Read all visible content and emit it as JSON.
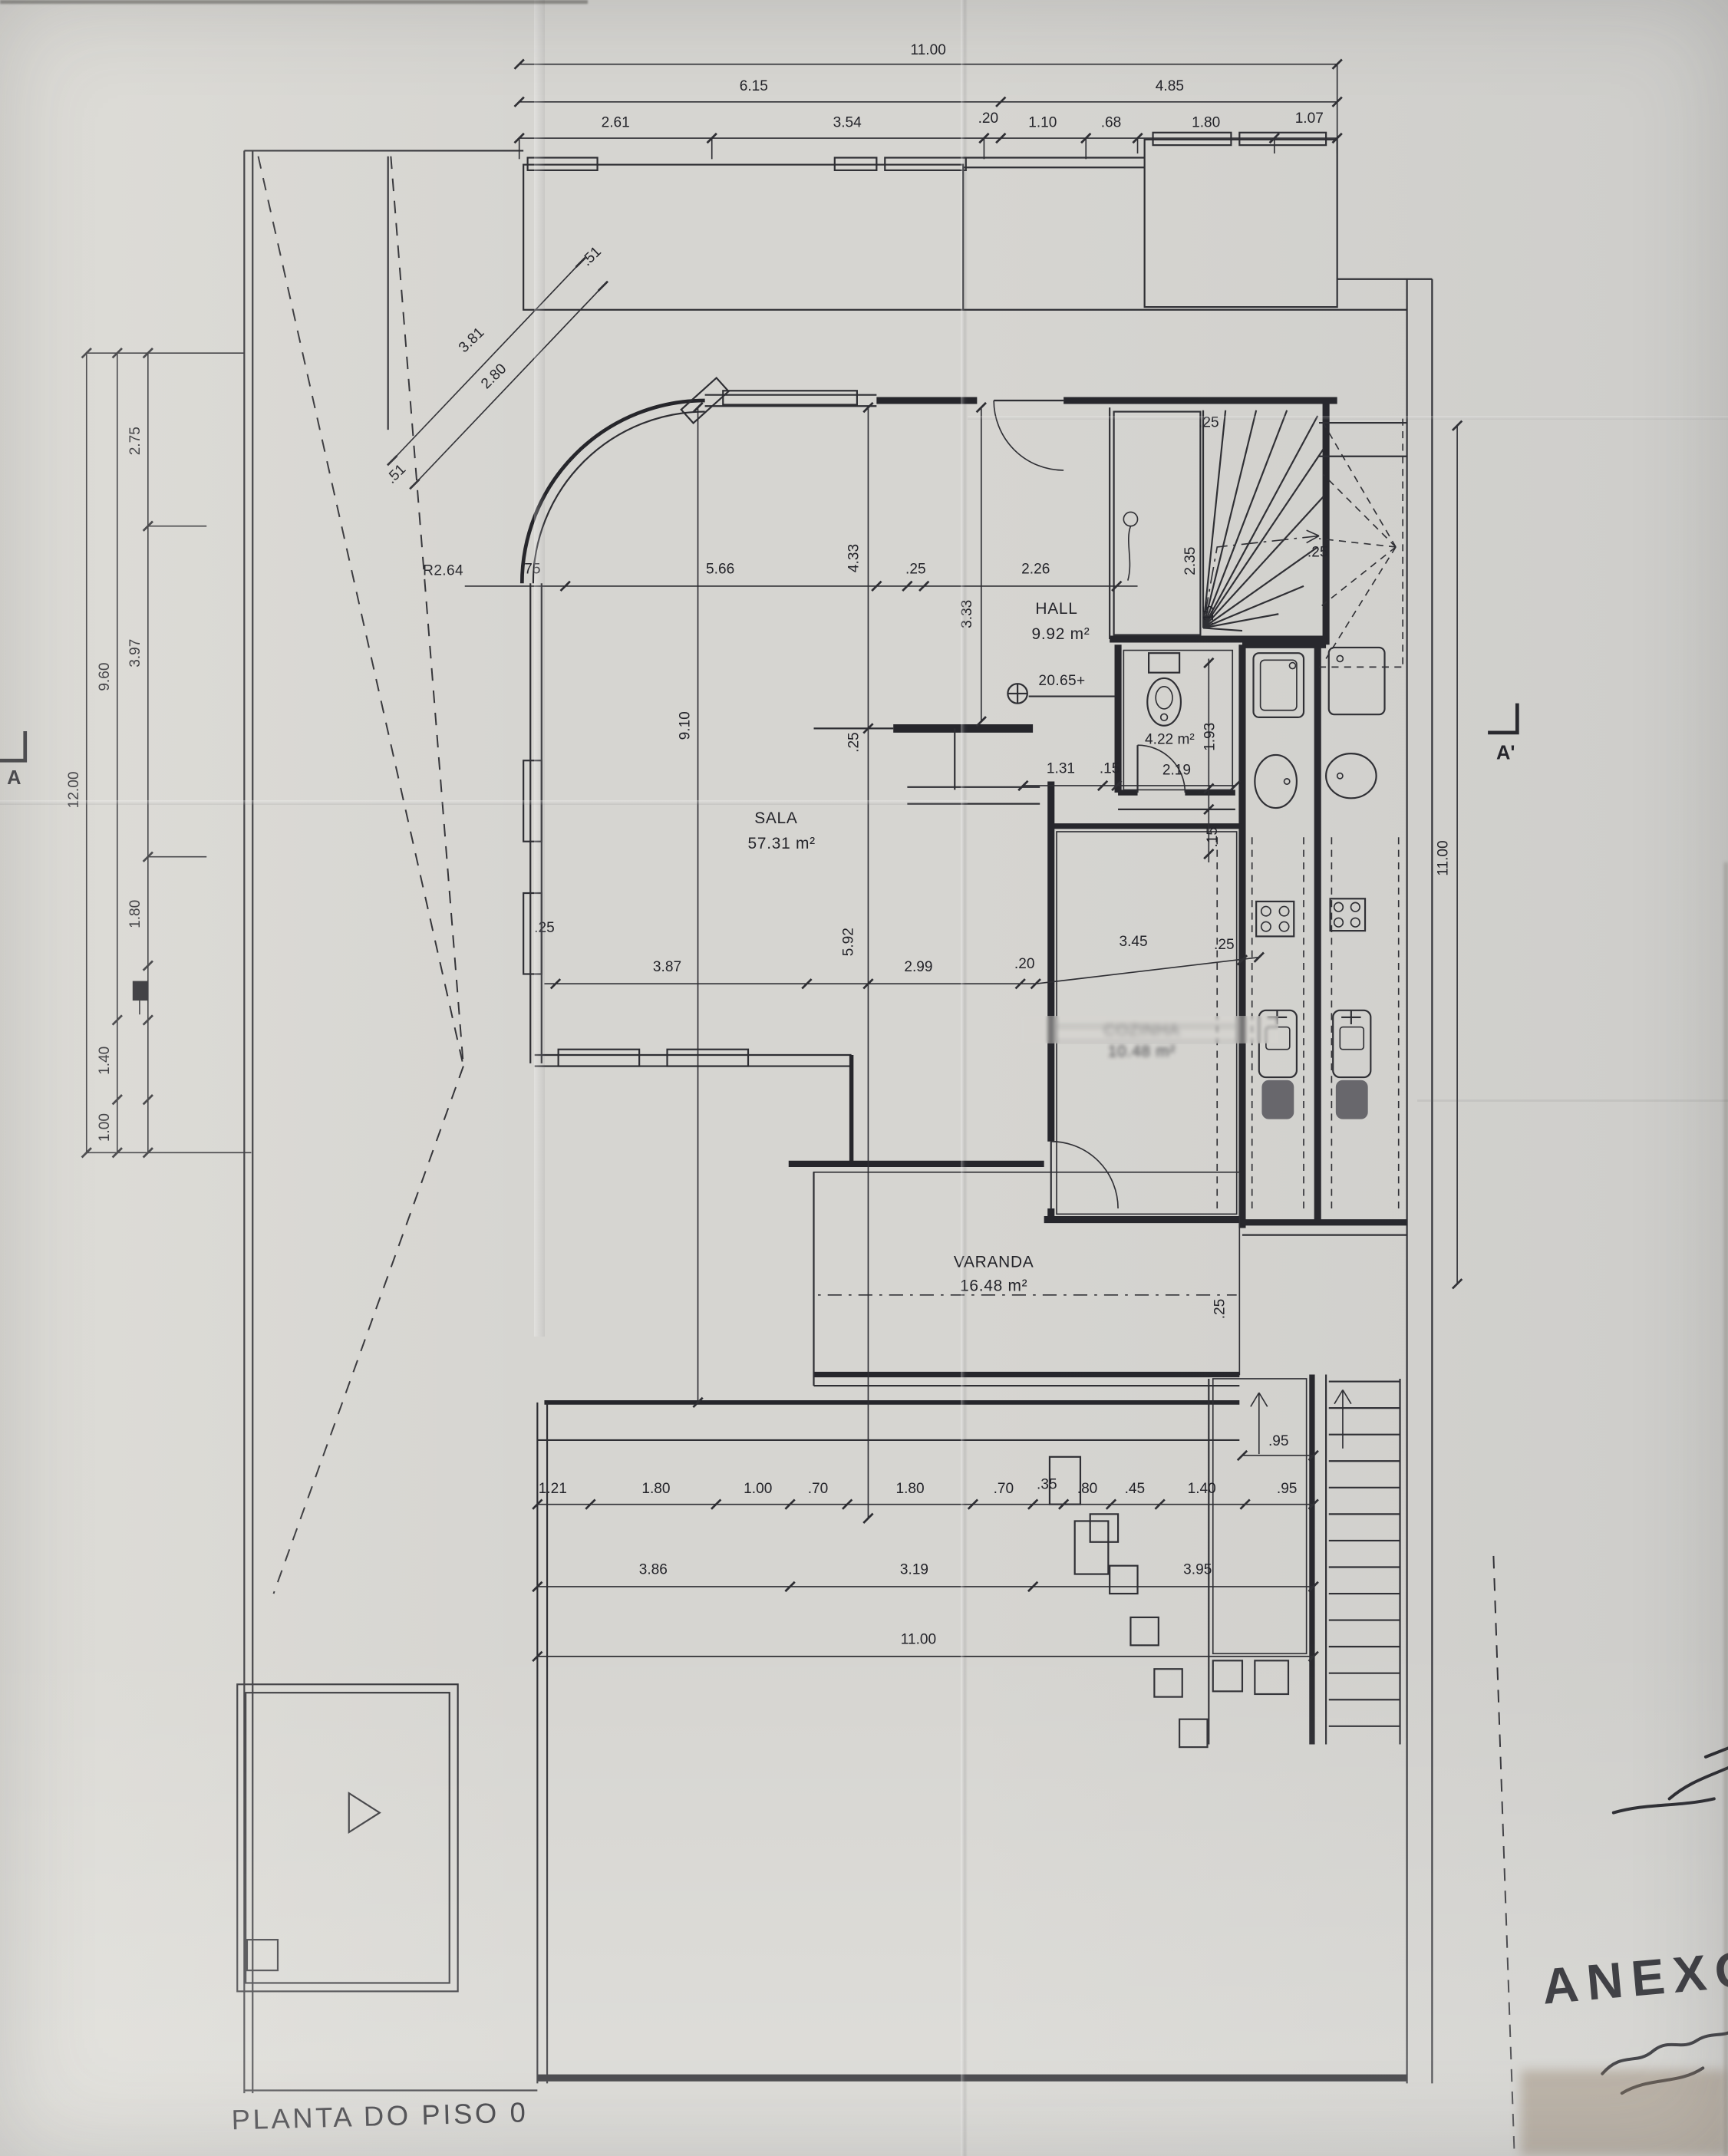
{
  "sheet": {
    "title": "PLANTA DO PISO 0",
    "annex_label": "ANEXO"
  },
  "rooms": {
    "sala": {
      "name": "SALA",
      "area": "57.31 m²"
    },
    "hall": {
      "name": "HALL",
      "area": "9.92 m²"
    },
    "cozinha": {
      "name": "COZINHA",
      "area": "10.48 m²"
    },
    "varanda": {
      "name": "VARANDA",
      "area": "16.48 m²"
    },
    "wc": {
      "area": "4.22 m²"
    }
  },
  "markers": {
    "level": "20.65+",
    "radius": "R2.64",
    "section_left": "A",
    "section_right": "A'"
  },
  "dims": {
    "top1": [
      "11.00"
    ],
    "top2": [
      "6.15",
      "4.85"
    ],
    "top3": [
      "2.61",
      "3.54",
      ".20",
      "1.10",
      ".68",
      "1.80",
      "1.07"
    ],
    "left_outer": [
      "12.00"
    ],
    "left_mid": [
      "9.60",
      "1.40",
      "1.00"
    ],
    "left_inner": [
      "2.75",
      "3.97",
      "1.80"
    ],
    "diag": [
      "3.81",
      "2.80",
      ".51",
      ".51"
    ],
    "sala_row": [
      ".75",
      "5.66",
      ".25",
      "2.26"
    ],
    "sala_vert": [
      "9.10",
      "4.33",
      ".25",
      "5.92",
      "3.33"
    ],
    "mid_row": [
      ".25",
      "3.87",
      "2.99",
      ".20",
      "3.45",
      ".25"
    ],
    "bath_row": [
      "1.31",
      ".15",
      "2.19"
    ],
    "bath_vert": [
      "1.93",
      ".15"
    ],
    "stairs": [
      ".25",
      "2.35",
      ".15",
      ".25"
    ],
    "kitchen_vert": [
      ".25"
    ],
    "right": [
      "11.00"
    ],
    "bottom1": [
      "1.21",
      "1.80",
      "1.00",
      ".70",
      "1.80",
      ".70",
      ".35",
      ".80",
      ".45",
      "1.40",
      ".95"
    ],
    "bottom2": [
      "3.86",
      "3.19",
      "3.95"
    ],
    "bottom3": [
      "11.00"
    ],
    "stair_width": [
      ".95"
    ]
  }
}
